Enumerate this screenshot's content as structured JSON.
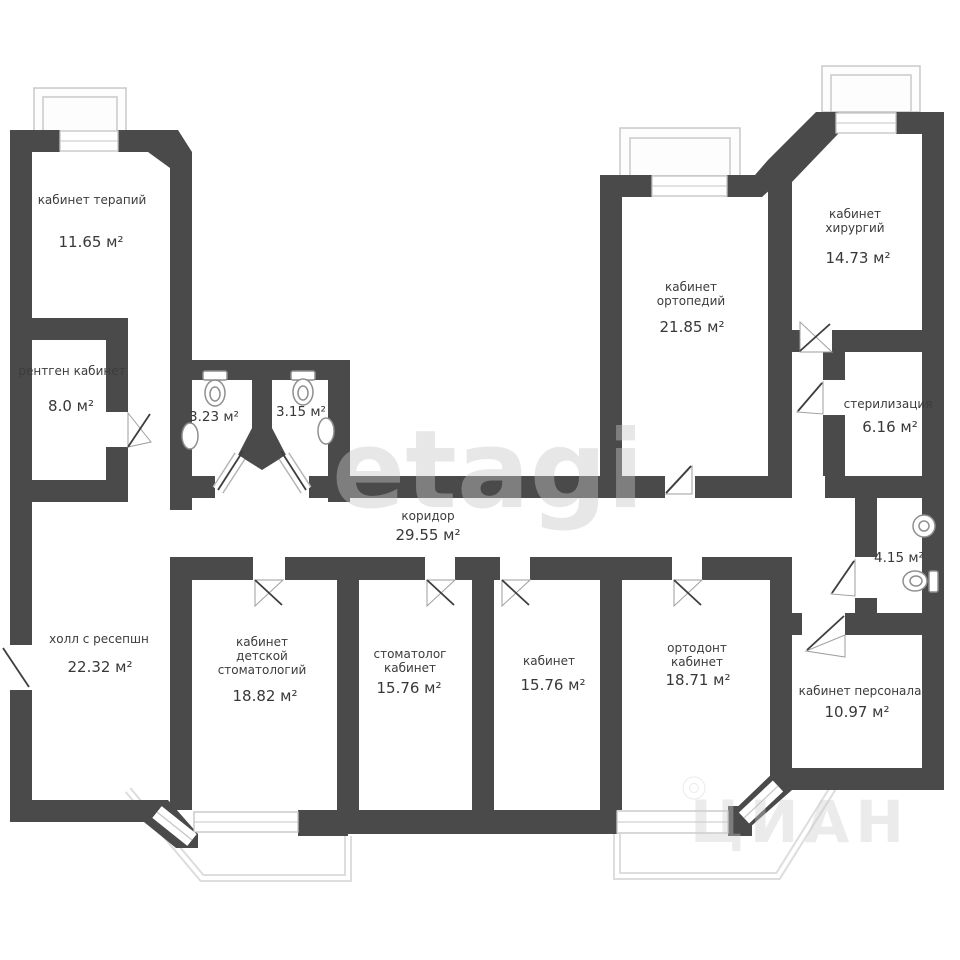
{
  "plan": {
    "watermark_center": "etagi",
    "watermark_corner": "ЦИАН",
    "wall_color": "#4a4a4b",
    "rooms": [
      {
        "name": "кабинет терапий",
        "area": "11.65 м²"
      },
      {
        "name": "рентген кабинет",
        "area": "8.0 м²"
      },
      {
        "name": "",
        "area": "3.23 м²"
      },
      {
        "name": "",
        "area": "3.15 м²"
      },
      {
        "name": "коридор",
        "area": "29.55 м²"
      },
      {
        "name": "холл с ресепшн",
        "area": "22.32 м²"
      },
      {
        "name": "кабинет детской стоматологий",
        "area": "18.82 м²"
      },
      {
        "name": "стоматолог кабинет",
        "area": "15.76 м²"
      },
      {
        "name": "кабинет",
        "area": "15.76 м²"
      },
      {
        "name": "ортодонт кабинет",
        "area": "18.71 м²"
      },
      {
        "name": "кабинет ортопедий",
        "area": "21.85 м²"
      },
      {
        "name": "кабинет хирургий",
        "area": "14.73 м²"
      },
      {
        "name": "стерилизация",
        "area": "6.16 м²"
      },
      {
        "name": "",
        "area": "4.15 м²"
      },
      {
        "name": "кабинет персонала",
        "area": "10.97 м²"
      }
    ]
  }
}
